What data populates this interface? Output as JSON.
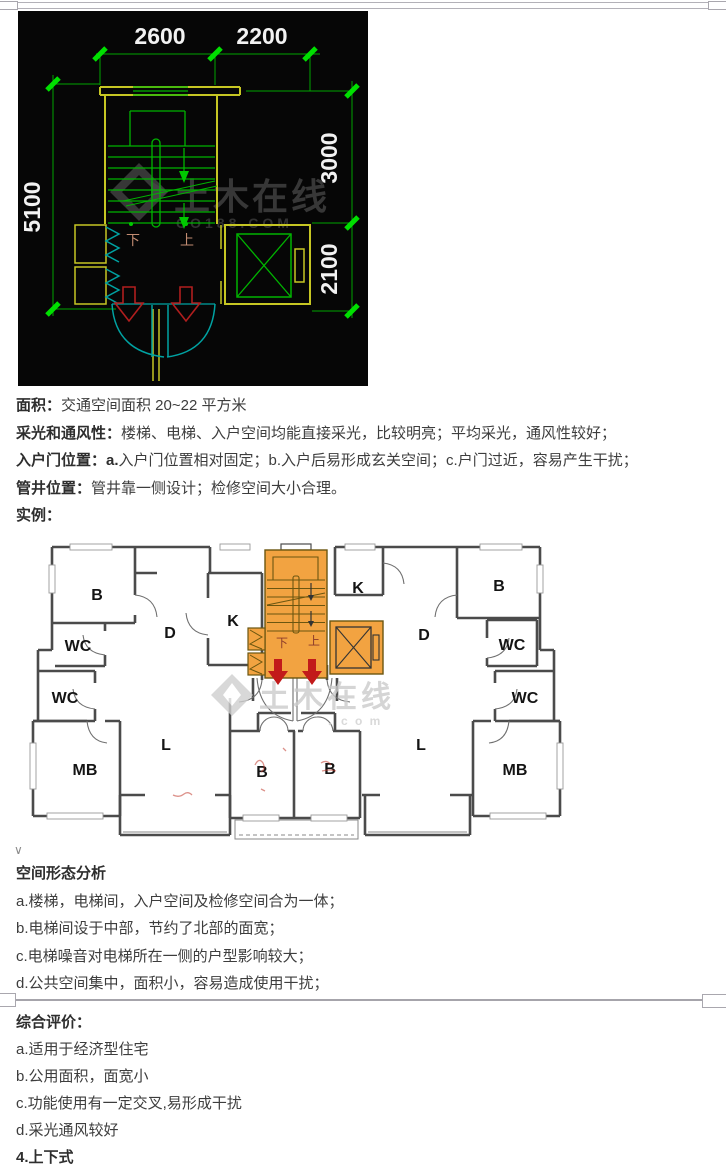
{
  "cad": {
    "dim_top_left": "2600",
    "dim_top_right": "2200",
    "dim_left": "5100",
    "dim_right_top": "3000",
    "dim_right_bottom": "2100",
    "label_down": "下",
    "label_up": "上",
    "watermark": {
      "line1": "土木在线",
      "line2": "CO188.COM"
    }
  },
  "intro": {
    "lines": [
      {
        "label": "面积：",
        "text": "交通空间面积 20~22 平方米"
      },
      {
        "label": "采光和通风性：",
        "text": "楼梯、电梯、入户空间均能直接采光，比较明亮；平均采光，通风性较好；"
      },
      {
        "label": "入户门位置：a.",
        "text": "入户门位置相对固定；b.入户后易形成玄关空间；c.户门过近，容易产生干扰；"
      },
      {
        "label": "管井位置：",
        "text": "管井靠一侧设计；检修空间大小合理。"
      },
      {
        "label": "实例：",
        "text": ""
      }
    ]
  },
  "plan": {
    "rooms": [
      "B",
      "WC",
      "WC",
      "MB",
      "D",
      "K",
      "L",
      "B",
      "B",
      "K",
      "B",
      "D",
      "WC",
      "WC",
      "L",
      "MB"
    ],
    "label_down": "下",
    "label_up": "上",
    "watermark": {
      "line1": "土木在线",
      "line2": "．c o m"
    },
    "core_color": "#F2A341",
    "arrow_color": "#C21A1A"
  },
  "analysis": {
    "title": "空间形态分析",
    "items": [
      "a.楼梯，电梯间，入户空间及检修空间合为一体；",
      "b.电梯间设于中部，节约了北部的面宽；",
      "c.电梯噪音对电梯所在一侧的户型影响较大；",
      "d.公共空间集中，面积小，容易造成使用干扰；"
    ]
  },
  "evaluation": {
    "title": "综合评价：",
    "items": [
      "a.适用于经济型住宅",
      "b.公用面积，面宽小",
      "c.功能使用有一定交叉,易形成干扰",
      "d.采光通风较好"
    ]
  },
  "next_heading": "4.上下式",
  "misc": {
    "caret": "∨"
  }
}
